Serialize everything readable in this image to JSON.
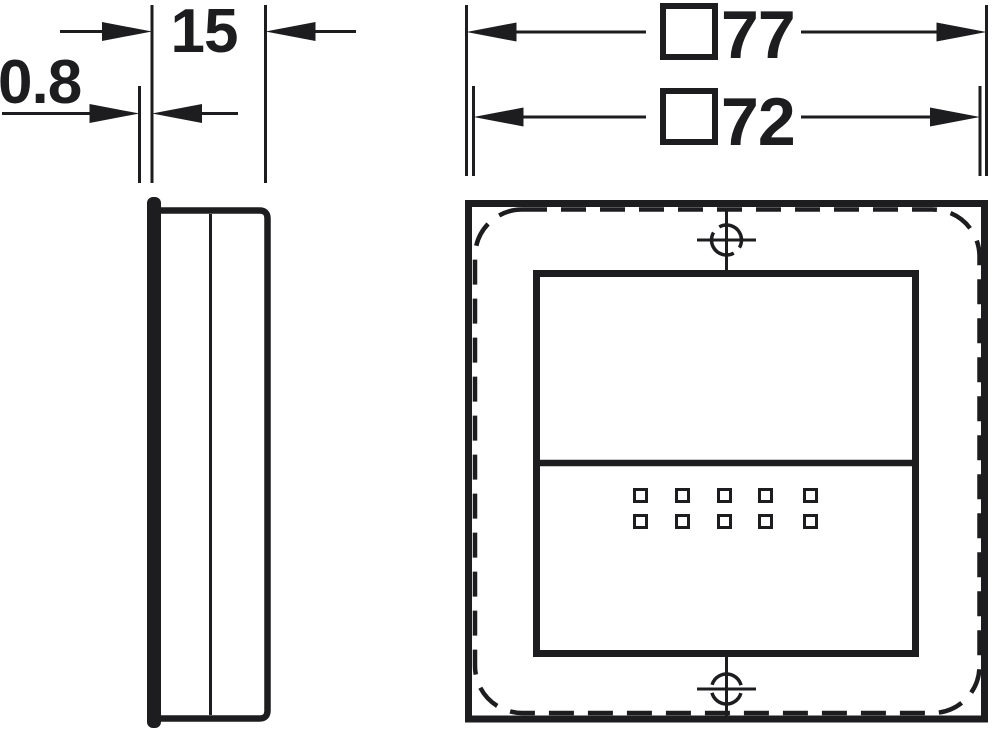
{
  "colors": {
    "ink": "#1d1d20",
    "background": "#ffffff"
  },
  "dimensions": {
    "depth": {
      "value": "15"
    },
    "plate_thickness": {
      "value": "0.8"
    },
    "outer_size": {
      "value": "77",
      "square_symbol": true
    },
    "cutout_size": {
      "value": "72",
      "square_symbol": true
    }
  },
  "front_view": {
    "sensor_grid": {
      "rows": 2,
      "columns": 5
    },
    "screw_marks": 2,
    "outline_styles": {
      "outer": "solid",
      "mounting_cutout": "dashed-rounded",
      "rocker": "solid"
    }
  },
  "side_view": {
    "parts": [
      "front-plate",
      "housing-body"
    ]
  }
}
